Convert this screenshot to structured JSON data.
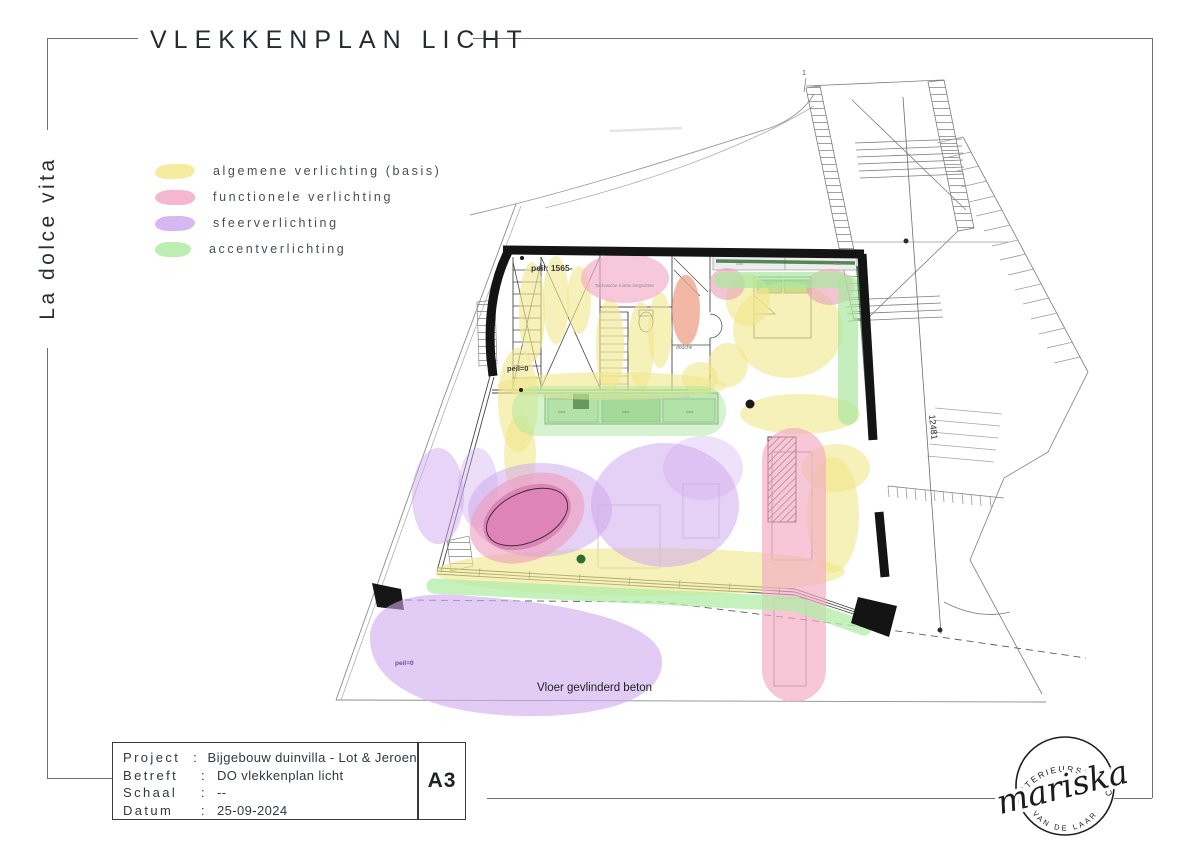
{
  "title": "VLEKKENPLAN LICHT",
  "side_text": "La dolce vita",
  "legend": {
    "items": [
      {
        "label": "algemene verlichting (basis)",
        "color": "#f5eca0",
        "key": "algemene"
      },
      {
        "label": "functionele verlichting",
        "color": "#f4b7ce",
        "key": "functionele"
      },
      {
        "label": "sfeerverlichting",
        "color": "#d6b7f2",
        "key": "sfeer"
      },
      {
        "label": "accentverlichting",
        "color": "#bdedb0",
        "key": "accent"
      }
    ]
  },
  "plan": {
    "labels": {
      "peil_upper": "peil: 1565-",
      "peil_zero": "peil=0",
      "peil_zero_terrace": "peil=0",
      "tech_room": "Technische ruimte bergruimte",
      "douche": "douche",
      "floor_note": "Vloer gevlinderd beton",
      "dimension": "12481",
      "marker_one": "1",
      "kast": "kast"
    },
    "colors": {
      "wall": "#141414",
      "yellow": "#f1e78e",
      "pink": "#f2a9c3",
      "pink_dark": "#d873ae",
      "salmon": "#ef9f88",
      "purple": "#cfaaee",
      "green": "#abe79e",
      "green_dark": "#2e6d31"
    }
  },
  "info": {
    "separator": ":",
    "rows": [
      {
        "label": "Project",
        "value": "Bijgebouw duinvilla - Lot & Jeroen"
      },
      {
        "label": "Betreft",
        "value": "DO vlekkenplan licht"
      },
      {
        "label": "Schaal",
        "value": "--"
      },
      {
        "label": "Datum",
        "value": "25-09-2024"
      }
    ],
    "paper_size": "A3"
  },
  "logo": {
    "arc_top": "INTERIEURSTUDIO",
    "name": "mariska",
    "arc_bottom": "VAN DE LAAR"
  }
}
